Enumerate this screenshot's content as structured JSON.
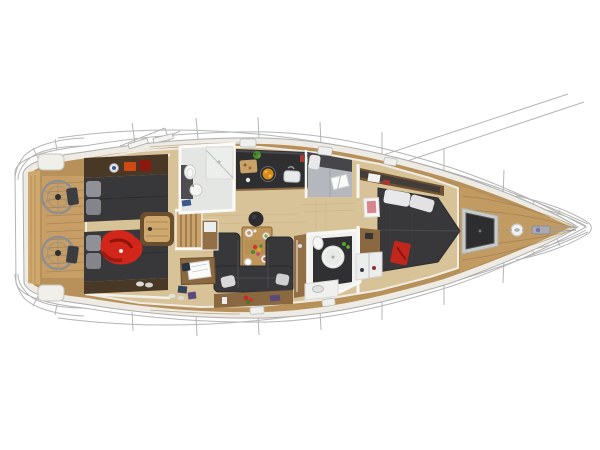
{
  "figure": {
    "subject": "Top-down cutaway layout render of a sailing yacht interior and deck",
    "orientation": "bow-right, stern-left"
  },
  "colors": {
    "background": "#ffffff",
    "outline_grey": "#b5b5b5",
    "hull_white": "#edebe4",
    "teak": "#b8905a",
    "teak_light": "#cfa86e",
    "teak_seam": "#8a6a3e",
    "cabin_floor": "#d8c398",
    "floor_seam": "#c3a87a",
    "wood_furniture": "#8a6840",
    "wood_dark": "#6b4e2e",
    "shelf_brown": "#4a3826",
    "sideboard": "#936f46",
    "table_wood": "#bf9657",
    "upholstery_charcoal": "#38383b",
    "upholstery_band": "#46464a",
    "cushion_grey": "#b4b8be",
    "pillow_white": "#e9e9eb",
    "pillow_grey": "#8f9196",
    "bathroom_white": "#f1f2f0",
    "bathroom_floor": "#e4e6e3",
    "wetroom_dark": "#303033",
    "counter_dark": "#2f2f32",
    "steel_grey": "#9a9ba2",
    "wheel_grey": "#8e8e90",
    "jacket_red": "#d2261b",
    "jacket_shadow": "#8e130a",
    "accent_red": "#d04a12",
    "dark_red": "#8a1a10",
    "accent_orange": "#d98a1a",
    "accent_yellow": "#e8c23c",
    "plant_green": "#4a8a2e",
    "white_trim": "#f6f6f3",
    "hatch_dark": "#2d2d30",
    "anchor_frame": "#c9cbc7"
  },
  "areas": [
    {
      "id": "transom-swim-platform"
    },
    {
      "id": "cockpit-twin-helms"
    },
    {
      "id": "aft-cabin-port"
    },
    {
      "id": "aft-cabin-starboard"
    },
    {
      "id": "cockpit-table"
    },
    {
      "id": "companionway-steps"
    },
    {
      "id": "aft-head"
    },
    {
      "id": "galley"
    },
    {
      "id": "port-settee-berth"
    },
    {
      "id": "saloon"
    },
    {
      "id": "nav-station"
    },
    {
      "id": "forward-head"
    },
    {
      "id": "forward-cabin"
    },
    {
      "id": "foredeck-anchor-locker"
    },
    {
      "id": "bow-fitting"
    }
  ]
}
